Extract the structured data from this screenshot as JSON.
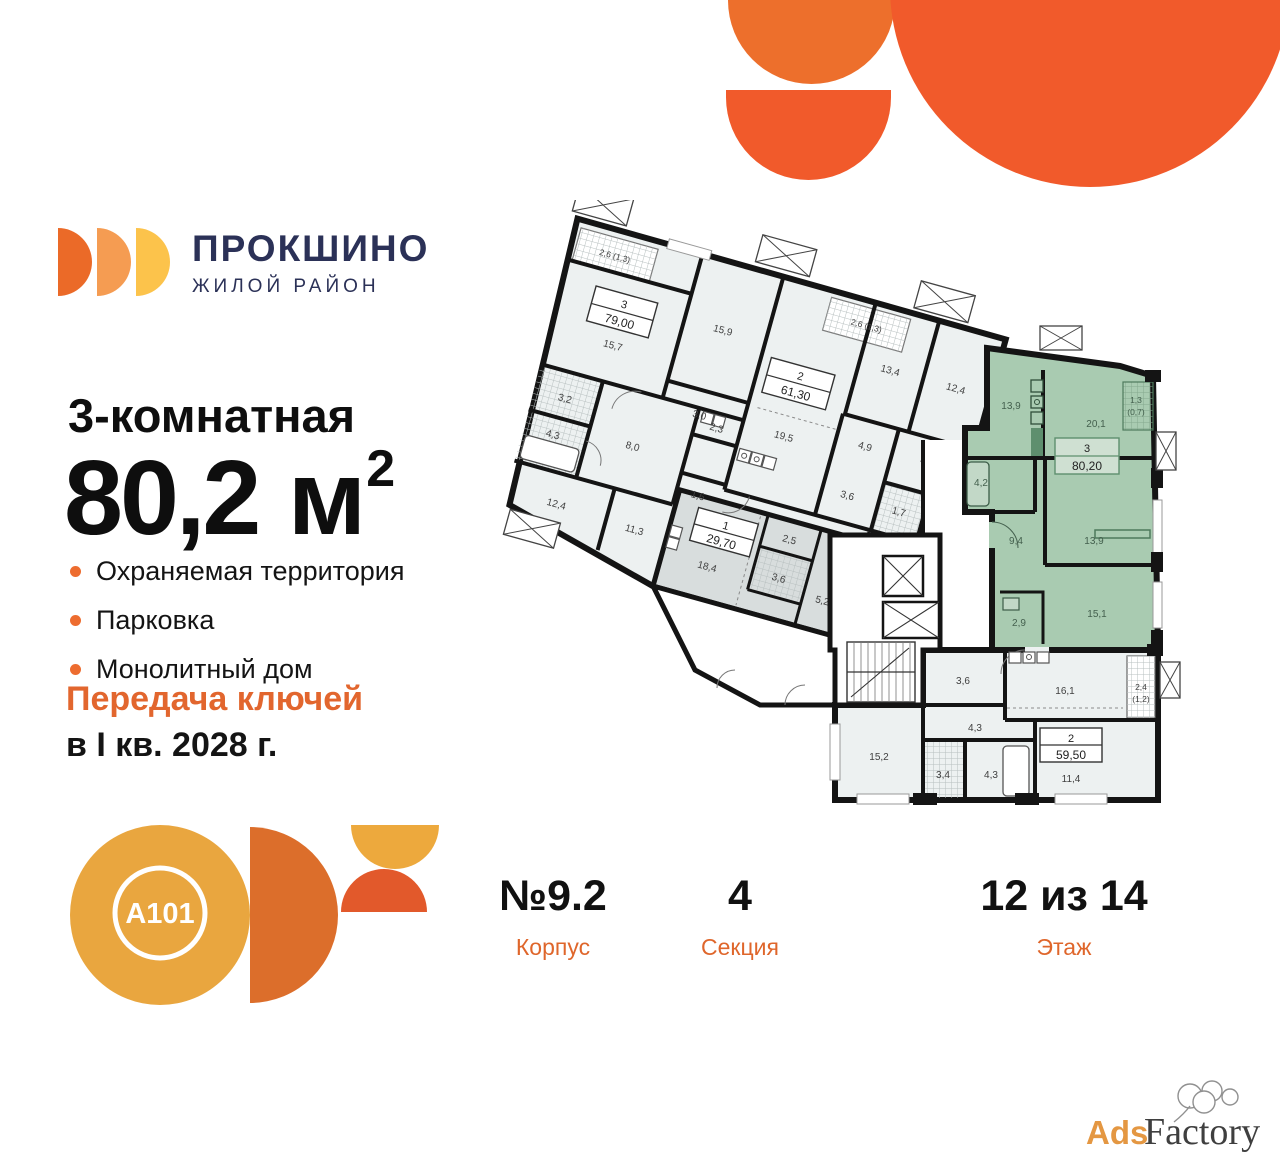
{
  "brand": {
    "name": "ПРОКШИНО",
    "tagline": "ЖИЛОЙ РАЙОН"
  },
  "headline": {
    "rooms_label": "3-комнатная",
    "area_value": "80,2",
    "area_unit": " м",
    "area_sup": "2"
  },
  "features": {
    "items": [
      "Охраняемая территория",
      "Парковка",
      "Монолитный дом"
    ]
  },
  "keys": {
    "line1": "Передача ключей",
    "line2": "в I кв. 2028 г."
  },
  "developer_logo": {
    "text": "A101"
  },
  "info": {
    "building_value": "№9.2",
    "building_label": "Корпус",
    "section_value": "4",
    "section_label": "Секция",
    "floor_value": "12 из 14",
    "floor_label": "Этаж"
  },
  "watermark": {
    "part1": "Ads",
    "part2": "Factory"
  },
  "colors": {
    "accent_orange": "#F15A2B",
    "logo_orange": "#EB6A28",
    "logo_light_orange": "#F59C52",
    "logo_yellow": "#FCC34B",
    "navy": "#2B3157",
    "bullet_orange": "#ED6C2F",
    "keys_orange": "#E2662E",
    "label_orange": "#DF662B",
    "highlight_green": "#A9CBB1",
    "apartment_grey": "#D8DDDD",
    "a101_gold": "#E9A63F",
    "a101_orange": "#DC6E2B"
  },
  "floorplan": {
    "apt79": {
      "type": "3",
      "area": "79,00",
      "balcony": "2,6 (1,3)",
      "rooms": [
        "15,7",
        "15,9",
        "3,0",
        "3,2",
        "4,3",
        "8,0",
        "2,3",
        "1,6",
        "12,4",
        "11,3"
      ]
    },
    "apt61": {
      "type": "2",
      "area": "61,30",
      "balcony": "2,6 (1,3)",
      "rooms": [
        "19,5",
        "13,4",
        "12,4",
        "4,9",
        "3,6",
        "1,7",
        "4,5"
      ]
    },
    "apt29": {
      "type": "1",
      "area": "29,70",
      "rooms": [
        "18,4",
        "2,5",
        "3,6",
        "5,2"
      ]
    },
    "apt80": {
      "type": "3",
      "area": "80,20",
      "balcony_line1": "1,3",
      "balcony_line2": "(0,7)",
      "rooms": [
        "13,9",
        "20,1",
        "4,2",
        "9,4",
        "13,9",
        "15,1",
        "2,9"
      ]
    },
    "apt59": {
      "type": "2",
      "area": "59,50",
      "balcony_line1": "2,4",
      "balcony_line2": "(1,2)",
      "rooms": [
        "3,6",
        "16,1",
        "4,3",
        "15,2",
        "3,4",
        "4,3",
        "11,4"
      ]
    }
  }
}
